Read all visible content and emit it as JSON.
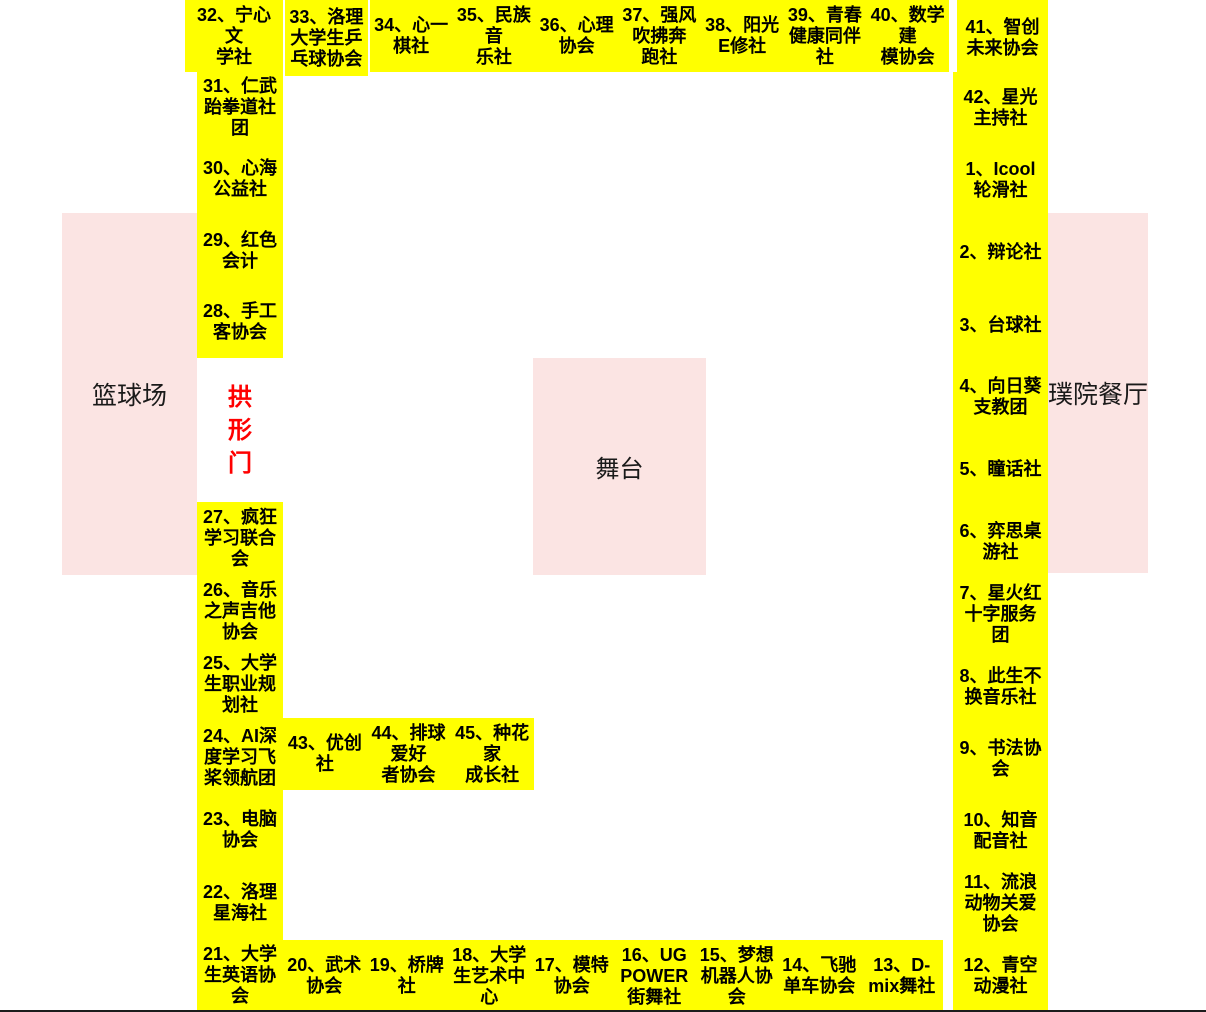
{
  "colors": {
    "booth_yellow": "#FFFF00",
    "area_pink": "#FBE4E3",
    "gate_text_red": "#FF0000",
    "booth_text_black": "#000000"
  },
  "landmarks": {
    "basketball_court": "篮球场",
    "stage": "舞台",
    "restaurant": "璞院餐厅",
    "arch_gate": "拱\n形\n门"
  },
  "booths": {
    "top_row": [
      "32、宁心\n文\n学社",
      "33、洛理\n大学生乒\n乓球协会",
      "34、心一\n棋社",
      "35、民族\n音\n乐社",
      "36、心理\n协会",
      "37、强风\n吹拂奔\n跑社",
      "38、阳光\nE修社",
      "39、青春\n健康同伴\n社",
      "40、数学\n建\n模协会",
      "41、智创\n未来协会"
    ],
    "left_column_upper": [
      "31、仁武\n跆拳道社\n团",
      "30、心海\n公益社",
      "29、红色\n会计",
      "28、手工\n客协会"
    ],
    "left_column_lower": [
      "27、疯狂\n学习联合\n会",
      "26、音乐\n之声吉他\n协会",
      "25、大学\n生职业规\n划社",
      "24、AI深\n度学习飞\n桨领航团",
      "23、电脑\n协会",
      "22、洛理\n星海社",
      "21、大学\n生英语协\n会"
    ],
    "middle_row": [
      "43、优创社",
      "44、排球\n爱好\n者协会",
      "45、种花\n家\n成长社"
    ],
    "bottom_row": [
      "20、武术\n协会",
      "19、桥牌\n社",
      "18、大学\n生艺术中\n心",
      "17、模特\n协会",
      "16、UG\nPOWER\n街舞社",
      "15、梦想\n机器人协\n会",
      "14、飞驰\n单车协会",
      "13、D-\nmix舞社"
    ],
    "right_column": [
      "42、星光\n主持社",
      "1、Icool\n轮滑社",
      "2、辩论社",
      "3、台球社",
      "4、向日葵\n支教团",
      "5、瞳话社",
      "6、弈思桌\n游社",
      "7、星火红\n十字服务\n团",
      "8、此生不\n换音乐社",
      "9、书法协\n会",
      "10、知音\n配音社",
      "11、流浪\n动物关爱\n协会",
      "12、青空\n动漫社"
    ]
  }
}
